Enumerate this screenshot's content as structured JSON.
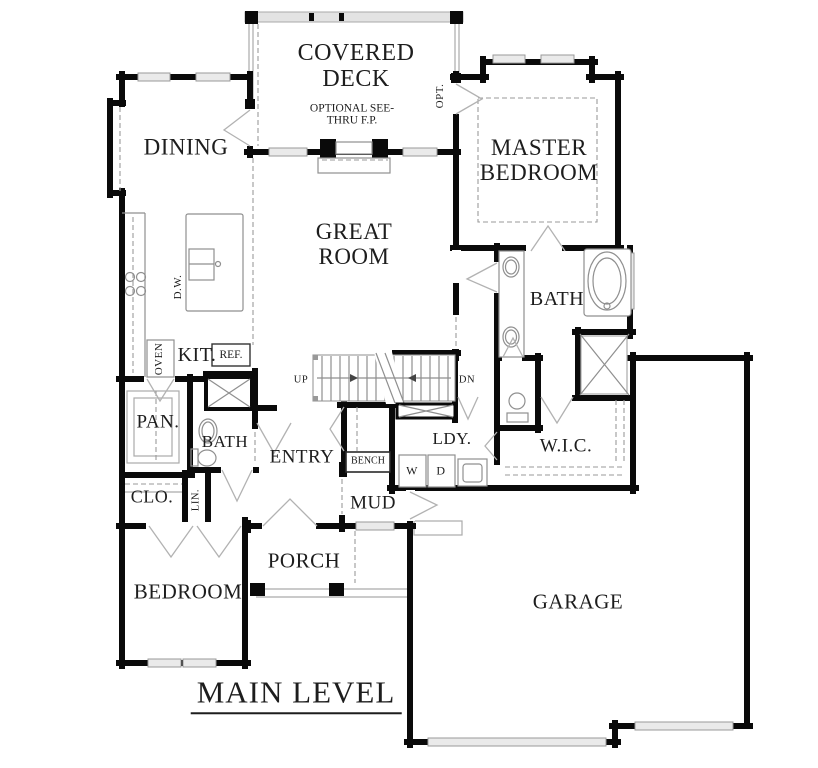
{
  "plan": {
    "title": "MAIN LEVEL",
    "rooms": {
      "covered_deck": "COVERED DECK",
      "dining": "DINING",
      "master_bedroom": "MASTER BEDROOM",
      "great_room": "GREAT ROOM",
      "master_bath": "BATH",
      "kitchen": "KIT.",
      "pantry": "PAN.",
      "hall_bath": "BATH",
      "entry": "ENTRY",
      "laundry": "LDY.",
      "walk_in_closet": "W.I.C.",
      "closet": "CLO.",
      "linen": "LIN.",
      "mud": "MUD",
      "bedroom": "BEDROOM",
      "porch": "PORCH",
      "garage": "GARAGE"
    },
    "annotations": {
      "optional_fireplace": "OPTIONAL SEE-THRU F.P.",
      "optional_door": "OPT.",
      "stairs_up": "UP",
      "stairs_down": "DN",
      "bench": "BENCH",
      "washer": "W",
      "dryer": "D",
      "dishwasher": "D.W.",
      "oven": "OVEN",
      "refrigerator": "REF."
    },
    "colors": {
      "wall": "#0a0a0a",
      "window": "#eaeaea",
      "fixture": "#8f8f8f"
    }
  }
}
